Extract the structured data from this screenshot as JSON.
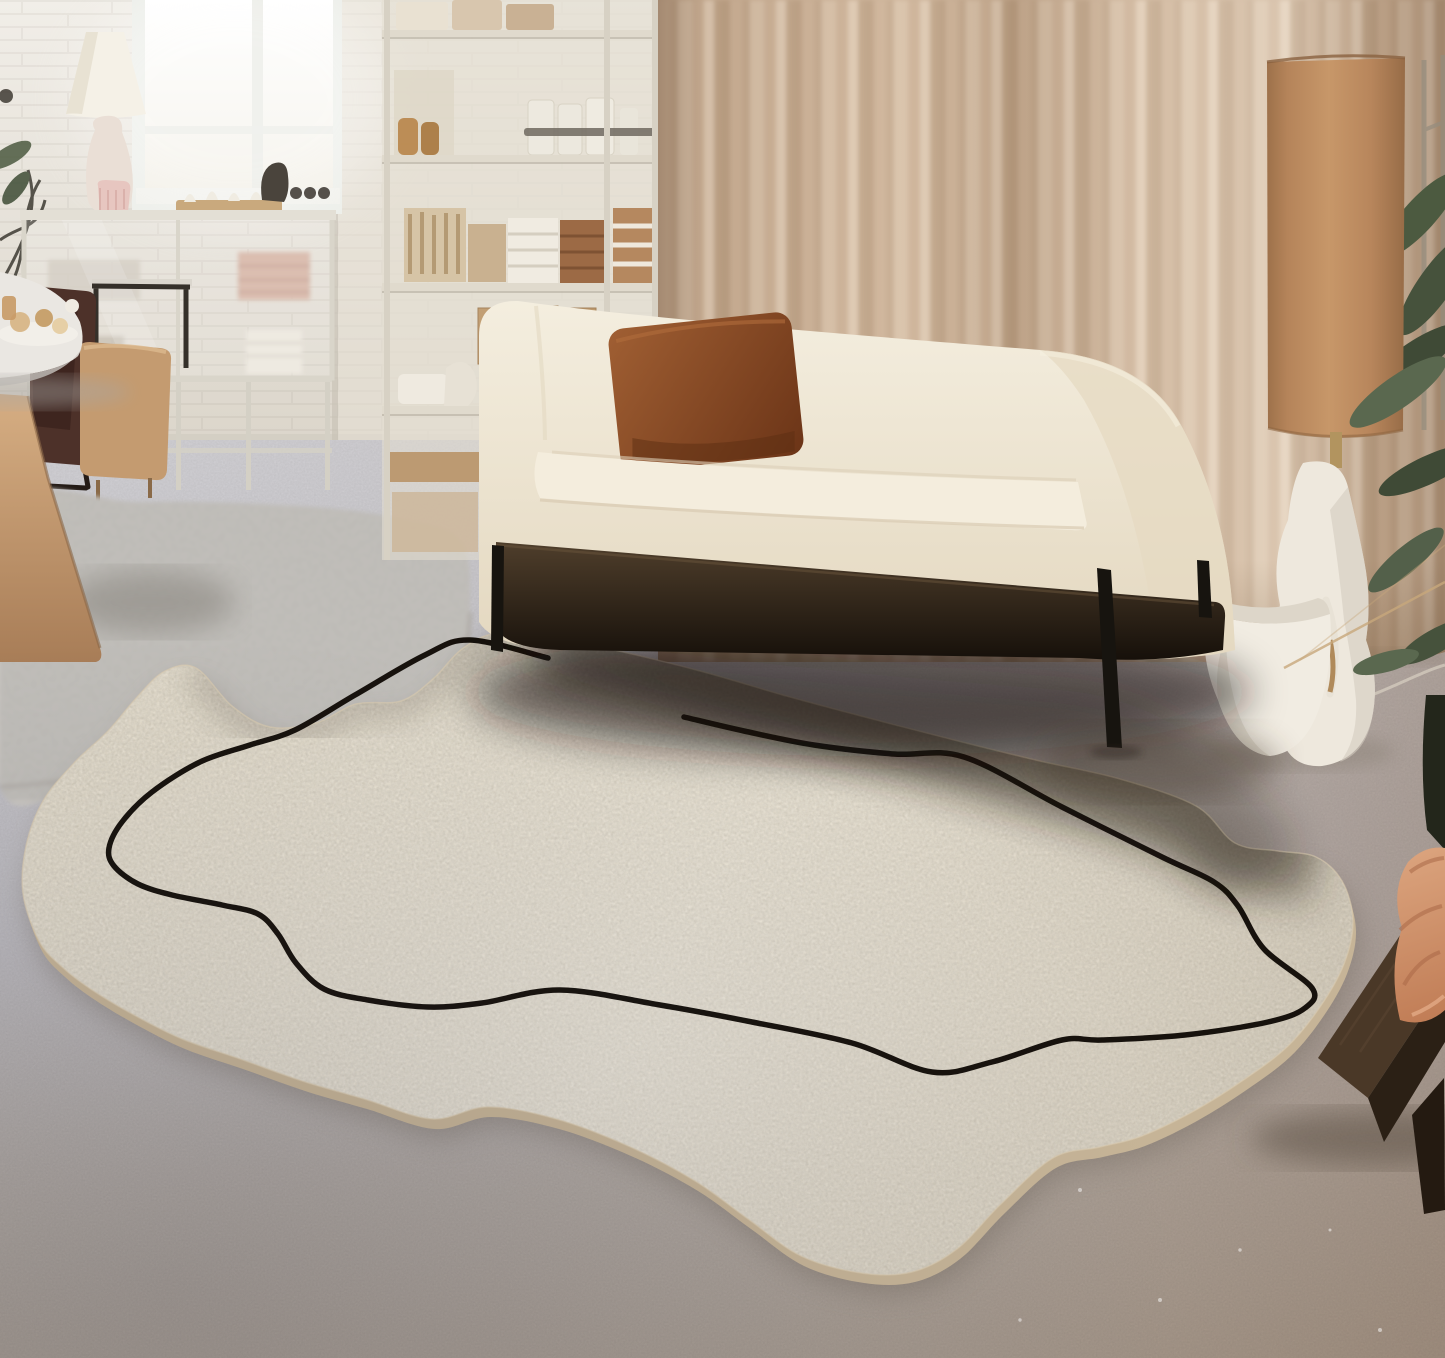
{
  "meta": {
    "title": "Minimalist living room with irregular organic cream rug and black single-line motif",
    "image_type": "interior product photograph",
    "no_visible_text": true
  },
  "palette": {
    "wall": "#ece8e0",
    "wall_low": "#dcd6cb",
    "window_glass": "#fdfdf9",
    "curtain": "#c9ae93",
    "curtain_highlight": "#e4d2bd",
    "curtain_shadow": "#a78b70",
    "sofa_cream": "#f1e9d8",
    "sofa_seat": "#f4eddd",
    "sofa_base_dark": "#1a130c",
    "pillow_brown": "#8a4e2a",
    "floor_cool": "#c9c8cd",
    "floor_warm": "#a89a8b",
    "rug_cream": "#eae2d0",
    "rug_side": "#c6b497",
    "rug_line": "#17120d",
    "grey_rug": "#c9c6c1",
    "lamp_shade_terracotta": "#bf8d60",
    "lamp_stem_brass": "#b2945f",
    "sculpture_white": "#eee8dd",
    "basket_white": "#f1ece2",
    "plant_dark": "#3f4a36",
    "plant_mid": "#4c5a40",
    "plant_light": "#5a684f",
    "bench_wood_top": "#4a3827",
    "bench_wood_front": "#2b2015",
    "fabric_peach": "#d09268",
    "wood_table": "#c9a276",
    "cabinet_frame": "#d9d5ca",
    "chair_dark": "#4d3129",
    "chair_camel": "#c49b70",
    "towel_brown": "#9c6a45",
    "towel_white": "#f0ebe1",
    "kraft_box": "#c29f74",
    "table_lamp_shade": "#f5f1e7",
    "table_lamp_base": "#eadfd6",
    "table_lamp_pink": "#e7c6c0"
  },
  "objects": [
    {
      "name": "window",
      "desc": "bright daylight window, white frame, left wall"
    },
    {
      "name": "table-lamp",
      "desc": "white cone shade, organic white base, pink ribbed vessel"
    },
    {
      "name": "display-cabinet",
      "desc": "glass cabinet with folded pink and white towels"
    },
    {
      "name": "storage-shelf",
      "desc": "tall open shelf: jars, bottles, folded towels, kraft boxes"
    },
    {
      "name": "round-table",
      "desc": "white round table with pastries, far left"
    },
    {
      "name": "chairs",
      "desc": "dark draped chair and camel chair"
    },
    {
      "name": "wood-table-slab",
      "desc": "light oak table pedestal, far left"
    },
    {
      "name": "grey-area-rug",
      "desc": "small grey textured rug on left"
    },
    {
      "name": "sofa",
      "desc": "cream two-seat sofa, black metal legs, brown leather cushion"
    },
    {
      "name": "curtains",
      "desc": "floor-length beige linen curtains"
    },
    {
      "name": "floor-lamp",
      "desc": "tall terracotta cylinder shade, brass stem"
    },
    {
      "name": "sculpture-vase",
      "desc": "organic white plaster sculpture"
    },
    {
      "name": "basket-planter",
      "desc": "white round basket pot with handles"
    },
    {
      "name": "plant",
      "desc": "green foliage at right edge with trellis"
    },
    {
      "name": "bench",
      "desc": "dark walnut bench, bottom right"
    },
    {
      "name": "draped-fabric",
      "desc": "peach garment folded on bench"
    },
    {
      "name": "cream-rug",
      "desc": "irregular organic-shaped cream boucle rug with single black wavy line"
    }
  ],
  "rug": {
    "fill": "#eae2d0",
    "side": "#c6b497",
    "line_color": "#17120d",
    "line_width": 5.5,
    "outline": [
      [
        497,
        633
      ],
      [
        462,
        649
      ],
      [
        433,
        679
      ],
      [
        401,
        701
      ],
      [
        356,
        704
      ],
      [
        316,
        723
      ],
      [
        270,
        727
      ],
      [
        232,
        706
      ],
      [
        196,
        668
      ],
      [
        165,
        671
      ],
      [
        138,
        696
      ],
      [
        108,
        731
      ],
      [
        74,
        763
      ],
      [
        43,
        801
      ],
      [
        26,
        846
      ],
      [
        23,
        894
      ],
      [
        39,
        941
      ],
      [
        62,
        967
      ],
      [
        92,
        990
      ],
      [
        132,
        1014
      ],
      [
        182,
        1039
      ],
      [
        240,
        1059
      ],
      [
        302,
        1081
      ],
      [
        364,
        1099
      ],
      [
        432,
        1119
      ],
      [
        488,
        1107
      ],
      [
        556,
        1119
      ],
      [
        628,
        1146
      ],
      [
        695,
        1181
      ],
      [
        748,
        1219
      ],
      [
        801,
        1256
      ],
      [
        861,
        1273
      ],
      [
        912,
        1272
      ],
      [
        957,
        1249
      ],
      [
        1001,
        1204
      ],
      [
        1053,
        1158
      ],
      [
        1100,
        1147
      ],
      [
        1142,
        1136
      ],
      [
        1194,
        1111
      ],
      [
        1242,
        1081
      ],
      [
        1287,
        1047
      ],
      [
        1320,
        1007
      ],
      [
        1344,
        964
      ],
      [
        1353,
        921
      ],
      [
        1342,
        881
      ],
      [
        1316,
        857
      ],
      [
        1278,
        851
      ],
      [
        1235,
        843
      ],
      [
        1196,
        806
      ],
      [
        1120,
        779
      ],
      [
        1040,
        761
      ],
      [
        966,
        743
      ],
      [
        880,
        721
      ],
      [
        790,
        697
      ],
      [
        700,
        671
      ],
      [
        610,
        649
      ],
      [
        549,
        637
      ]
    ],
    "line": [
      [
        548,
        658
      ],
      [
        470,
        640
      ],
      [
        425,
        655
      ],
      [
        355,
        695
      ],
      [
        295,
        730
      ],
      [
        250,
        745
      ],
      [
        200,
        762
      ],
      [
        152,
        792
      ],
      [
        122,
        822
      ],
      [
        109,
        848
      ],
      [
        114,
        866
      ],
      [
        138,
        884
      ],
      [
        172,
        895
      ],
      [
        222,
        905
      ],
      [
        258,
        914
      ],
      [
        278,
        934
      ],
      [
        296,
        963
      ],
      [
        324,
        989
      ],
      [
        368,
        1000
      ],
      [
        428,
        1007
      ],
      [
        482,
        1003
      ],
      [
        560,
        990
      ],
      [
        660,
        1005
      ],
      [
        752,
        1022
      ],
      [
        852,
        1043
      ],
      [
        932,
        1072
      ],
      [
        992,
        1062
      ],
      [
        1062,
        1040
      ],
      [
        1102,
        1040
      ],
      [
        1185,
        1035
      ],
      [
        1268,
        1022
      ],
      [
        1305,
        1008
      ],
      [
        1312,
        988
      ],
      [
        1264,
        949
      ],
      [
        1238,
        906
      ],
      [
        1214,
        882
      ],
      [
        1162,
        857
      ],
      [
        1062,
        807
      ],
      [
        964,
        757
      ],
      [
        894,
        754
      ],
      [
        814,
        745
      ],
      [
        744,
        731
      ],
      [
        684,
        717
      ]
    ],
    "top_shadow": [
      [
        549,
        637
      ],
      [
        610,
        649
      ],
      [
        700,
        671
      ],
      [
        790,
        697
      ],
      [
        880,
        721
      ],
      [
        966,
        743
      ],
      [
        1040,
        761
      ],
      [
        1120,
        779
      ],
      [
        1196,
        806
      ],
      [
        1235,
        843
      ],
      [
        1278,
        851
      ],
      [
        1316,
        857
      ]
    ],
    "left_shadow": [
      [
        497,
        633
      ],
      [
        462,
        649
      ],
      [
        433,
        679
      ],
      [
        401,
        701
      ],
      [
        356,
        704
      ],
      [
        316,
        723
      ],
      [
        270,
        727
      ],
      [
        232,
        706
      ],
      [
        196,
        668
      ]
    ]
  },
  "grey_rug": {
    "fill": "#c9c6c1",
    "outline": [
      [
        0,
        512
      ],
      [
        140,
        502
      ],
      [
        300,
        506
      ],
      [
        408,
        520
      ],
      [
        462,
        543
      ],
      [
        470,
        612
      ],
      [
        464,
        694
      ],
      [
        415,
        714
      ],
      [
        330,
        738
      ],
      [
        215,
        762
      ],
      [
        95,
        780
      ],
      [
        0,
        787
      ]
    ]
  }
}
